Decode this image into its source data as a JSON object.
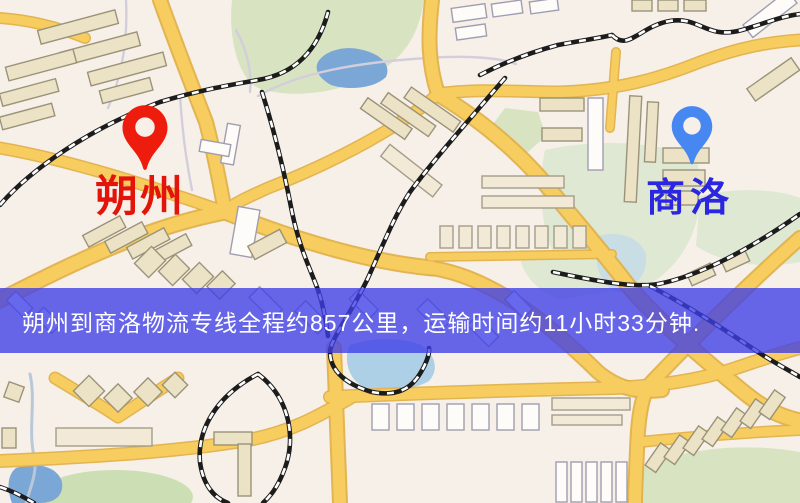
{
  "banner": {
    "text": "朔州到商洛物流专线全程约857公里，运输时间约11小时33分钟.",
    "bg_color": "rgba(62,62,232,0.78)",
    "text_color": "#ffffff"
  },
  "markers": {
    "origin": {
      "label": "朔州",
      "label_color": "#e3150b",
      "pin_color": "#ee1c0d"
    },
    "destination": {
      "label": "商洛",
      "label_color": "#2b26e0",
      "pin_color": "#4687f2"
    }
  },
  "map": {
    "colors": {
      "background": "#f6f0e8",
      "road": "#f5ca55",
      "road_casing": "#e2b04a",
      "building_white": "#fdfcf8",
      "building_tan": "#ece3c6",
      "park_green": "#d8e3c2",
      "water": "#7ba7d6",
      "railway": "#1c1c1c",
      "railway_dash": "#ffffff"
    }
  }
}
